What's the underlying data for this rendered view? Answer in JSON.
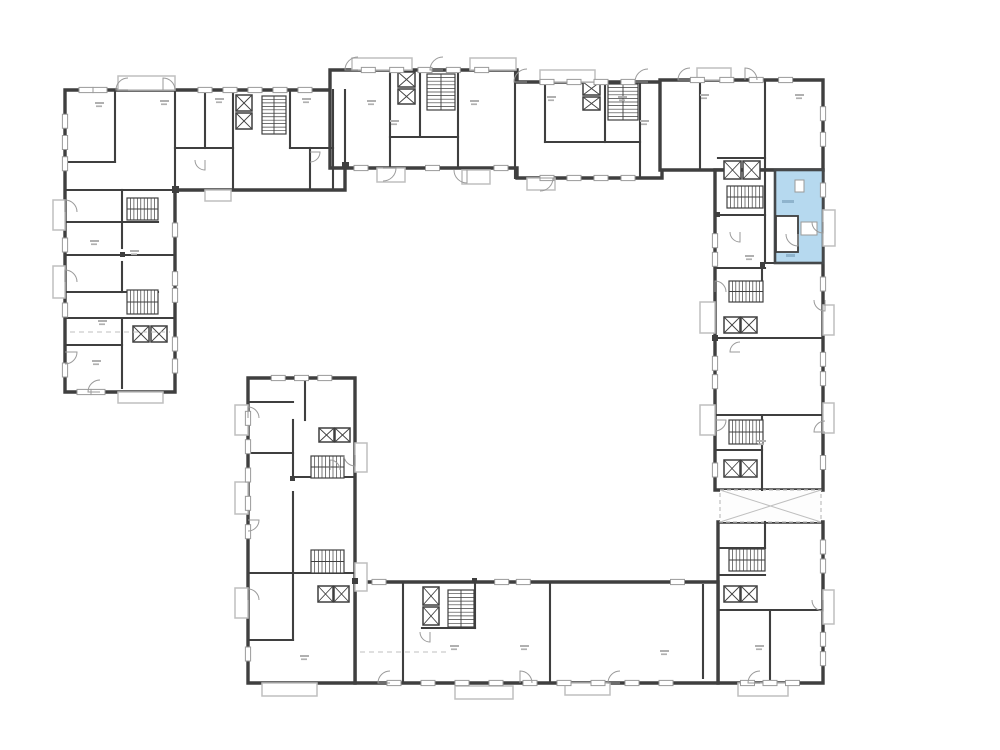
{
  "meta": {
    "title": "building-floor-plan",
    "canvas": {
      "w": 1000,
      "h": 750
    },
    "colors": {
      "background": "#ffffff",
      "wall": "#3f3f3f",
      "wall_medium": "#6a6a6a",
      "thin": "#9a9a9a",
      "lighter": "#bfbfbf",
      "smudge": "#b0b0b0",
      "highlight_fill": "#b6d9ef",
      "highlight_stroke": "#45484a"
    }
  },
  "plan": {
    "wings": [
      {
        "name": "left-l-wing",
        "points": "65,90 345,90 345,190 175,190 175,392 65,392"
      },
      {
        "name": "top-middle-wing",
        "points": "330,70 517,70 517,82 662,82 662,178 517,178 517,168 330,168"
      },
      {
        "name": "top-right-wing",
        "points": "660,80 823,80 823,170 660,170"
      },
      {
        "name": "right-wing",
        "points": "715,170 823,170 823,490 715,490"
      },
      {
        "name": "bottom-right-wing",
        "points": "718,522 823,522 823,683 718,683"
      },
      {
        "name": "bottom-wing",
        "points": "355,582 718,582 718,683 355,683"
      },
      {
        "name": "mid-left-wing",
        "points": "248,378 355,378 355,683 248,683"
      }
    ],
    "connector": {
      "x": 720,
      "y": 490,
      "w": 101,
      "h": 32
    },
    "interior_walls": [
      [
        115,
        90,
        115,
        162
      ],
      [
        175,
        90,
        175,
        190
      ],
      [
        205,
        90,
        205,
        148
      ],
      [
        233,
        90,
        233,
        190
      ],
      [
        290,
        90,
        290,
        148
      ],
      [
        310,
        148,
        310,
        190
      ],
      [
        333,
        90,
        333,
        190
      ],
      [
        175,
        148,
        233,
        148
      ],
      [
        290,
        148,
        333,
        148
      ],
      [
        65,
        162,
        115,
        162
      ],
      [
        65,
        190,
        175,
        190
      ],
      [
        65,
        222,
        158,
        222
      ],
      [
        65,
        255,
        175,
        255
      ],
      [
        65,
        292,
        158,
        292
      ],
      [
        65,
        318,
        175,
        318
      ],
      [
        65,
        345,
        122,
        345
      ],
      [
        122,
        190,
        122,
        248
      ],
      [
        122,
        262,
        122,
        292
      ],
      [
        122,
        318,
        122,
        388
      ],
      [
        345,
        90,
        345,
        168
      ],
      [
        390,
        70,
        390,
        168
      ],
      [
        420,
        70,
        420,
        137
      ],
      [
        458,
        70,
        458,
        168
      ],
      [
        515,
        70,
        515,
        178
      ],
      [
        545,
        82,
        545,
        142
      ],
      [
        605,
        82,
        605,
        142
      ],
      [
        640,
        82,
        640,
        178
      ],
      [
        390,
        137,
        458,
        137
      ],
      [
        545,
        142,
        640,
        142
      ],
      [
        700,
        80,
        700,
        170
      ],
      [
        765,
        80,
        765,
        170
      ],
      [
        718,
        158,
        765,
        158
      ],
      [
        765,
        170,
        765,
        263
      ],
      [
        763,
        263,
        823,
        263
      ],
      [
        715,
        215,
        765,
        215
      ],
      [
        715,
        268,
        765,
        268
      ],
      [
        715,
        338,
        823,
        338
      ],
      [
        715,
        415,
        823,
        415
      ],
      [
        762,
        415,
        762,
        490
      ],
      [
        715,
        450,
        762,
        450
      ],
      [
        762,
        268,
        762,
        300
      ],
      [
        718,
        548,
        765,
        548
      ],
      [
        765,
        522,
        765,
        548
      ],
      [
        718,
        575,
        765,
        575
      ],
      [
        718,
        610,
        823,
        610
      ],
      [
        770,
        610,
        770,
        683
      ],
      [
        403,
        582,
        403,
        683
      ],
      [
        550,
        582,
        550,
        683
      ],
      [
        703,
        585,
        703,
        678
      ],
      [
        422,
        628,
        475,
        628
      ],
      [
        475,
        582,
        475,
        628
      ],
      [
        293,
        420,
        293,
        478
      ],
      [
        293,
        492,
        293,
        640
      ],
      [
        248,
        402,
        293,
        402
      ],
      [
        248,
        453,
        293,
        453
      ],
      [
        293,
        477,
        355,
        477
      ],
      [
        248,
        573,
        355,
        573
      ],
      [
        305,
        378,
        305,
        420
      ],
      [
        248,
        640,
        293,
        640
      ]
    ],
    "stairs": [
      {
        "x": 262,
        "y": 96,
        "w": 24,
        "h": 38,
        "dir": "v"
      },
      {
        "x": 127,
        "y": 198,
        "w": 31,
        "h": 22,
        "dir": "h"
      },
      {
        "x": 127,
        "y": 290,
        "w": 31,
        "h": 24,
        "dir": "h"
      },
      {
        "x": 427,
        "y": 74,
        "w": 28,
        "h": 36,
        "dir": "v"
      },
      {
        "x": 608,
        "y": 84,
        "w": 30,
        "h": 36,
        "dir": "v"
      },
      {
        "x": 727,
        "y": 186,
        "w": 36,
        "h": 22,
        "dir": "h"
      },
      {
        "x": 729,
        "y": 281,
        "w": 34,
        "h": 21,
        "dir": "h"
      },
      {
        "x": 729,
        "y": 420,
        "w": 34,
        "h": 24,
        "dir": "h"
      },
      {
        "x": 729,
        "y": 549,
        "w": 36,
        "h": 22,
        "dir": "h"
      },
      {
        "x": 311,
        "y": 456,
        "w": 33,
        "h": 22,
        "dir": "h"
      },
      {
        "x": 311,
        "y": 550,
        "w": 33,
        "h": 23,
        "dir": "h"
      },
      {
        "x": 448,
        "y": 590,
        "w": 26,
        "h": 37,
        "dir": "v"
      }
    ],
    "elevators": [
      [
        236,
        95,
        16,
        16
      ],
      [
        236,
        113,
        16,
        16
      ],
      [
        133,
        326,
        16,
        16
      ],
      [
        151,
        326,
        16,
        16
      ],
      [
        398,
        72,
        17,
        15
      ],
      [
        398,
        89,
        17,
        15
      ],
      [
        583,
        82,
        17,
        13
      ],
      [
        583,
        97,
        17,
        13
      ],
      [
        724,
        161,
        17,
        18
      ],
      [
        743,
        161,
        17,
        18
      ],
      [
        724,
        317,
        16,
        16
      ],
      [
        741,
        317,
        16,
        16
      ],
      [
        724,
        460,
        16,
        17
      ],
      [
        741,
        460,
        16,
        17
      ],
      [
        724,
        586,
        16,
        16
      ],
      [
        741,
        586,
        16,
        16
      ],
      [
        319,
        428,
        15,
        14
      ],
      [
        335,
        428,
        15,
        14
      ],
      [
        318,
        586,
        15,
        16
      ],
      [
        334,
        586,
        15,
        16
      ],
      [
        423,
        587,
        16,
        18
      ],
      [
        423,
        607,
        16,
        18
      ]
    ],
    "balconies": [
      [
        118,
        76,
        57,
        14
      ],
      [
        53,
        200,
        12,
        30
      ],
      [
        53,
        266,
        12,
        32
      ],
      [
        352,
        58,
        60,
        12
      ],
      [
        470,
        58,
        46,
        12
      ],
      [
        540,
        70,
        55,
        12
      ],
      [
        377,
        168,
        28,
        14
      ],
      [
        462,
        170,
        28,
        14
      ],
      [
        527,
        178,
        28,
        12
      ],
      [
        697,
        68,
        34,
        12
      ],
      [
        823,
        210,
        12,
        36
      ],
      [
        823,
        305,
        11,
        30
      ],
      [
        823,
        403,
        11,
        30
      ],
      [
        700,
        302,
        15,
        31
      ],
      [
        700,
        405,
        15,
        30
      ],
      [
        823,
        590,
        11,
        34
      ],
      [
        738,
        683,
        50,
        13
      ],
      [
        262,
        683,
        55,
        13
      ],
      [
        455,
        686,
        58,
        13
      ],
      [
        565,
        683,
        45,
        12
      ],
      [
        235,
        405,
        13,
        30
      ],
      [
        235,
        482,
        13,
        32
      ],
      [
        235,
        588,
        13,
        30
      ],
      [
        355,
        443,
        12,
        29
      ],
      [
        355,
        563,
        12,
        28
      ],
      [
        205,
        190,
        26,
        11
      ],
      [
        118,
        392,
        45,
        11
      ]
    ],
    "windows": [
      {
        "x1": 72,
        "y1": 90,
        "x2": 114,
        "y2": 90,
        "n": 2
      },
      {
        "x1": 180,
        "y1": 90,
        "x2": 330,
        "y2": 90,
        "n": 5
      },
      {
        "x1": 65,
        "y1": 100,
        "x2": 65,
        "y2": 185,
        "n": 3
      },
      {
        "x1": 65,
        "y1": 228,
        "x2": 65,
        "y2": 262,
        "n": 1
      },
      {
        "x1": 65,
        "y1": 300,
        "x2": 65,
        "y2": 320,
        "n": 1
      },
      {
        "x1": 65,
        "y1": 355,
        "x2": 65,
        "y2": 385,
        "n": 1
      },
      {
        "x1": 70,
        "y1": 392,
        "x2": 112,
        "y2": 392,
        "n": 2
      },
      {
        "x1": 175,
        "y1": 210,
        "x2": 175,
        "y2": 250,
        "n": 1
      },
      {
        "x1": 175,
        "y1": 262,
        "x2": 175,
        "y2": 312,
        "n": 2
      },
      {
        "x1": 175,
        "y1": 322,
        "x2": 175,
        "y2": 388,
        "n": 2
      },
      {
        "x1": 340,
        "y1": 70,
        "x2": 510,
        "y2": 70,
        "n": 5
      },
      {
        "x1": 520,
        "y1": 82,
        "x2": 655,
        "y2": 82,
        "n": 4
      },
      {
        "x1": 350,
        "y1": 168,
        "x2": 372,
        "y2": 168,
        "n": 1
      },
      {
        "x1": 410,
        "y1": 168,
        "x2": 455,
        "y2": 168,
        "n": 1
      },
      {
        "x1": 490,
        "y1": 168,
        "x2": 512,
        "y2": 168,
        "n": 1
      },
      {
        "x1": 520,
        "y1": 178,
        "x2": 655,
        "y2": 178,
        "n": 4
      },
      {
        "x1": 668,
        "y1": 80,
        "x2": 815,
        "y2": 80,
        "n": 4
      },
      {
        "x1": 823,
        "y1": 88,
        "x2": 823,
        "y2": 165,
        "n": 2
      },
      {
        "x1": 823,
        "y1": 175,
        "x2": 823,
        "y2": 205,
        "n": 1
      },
      {
        "x1": 823,
        "y1": 268,
        "x2": 823,
        "y2": 300,
        "n": 1
      },
      {
        "x1": 823,
        "y1": 340,
        "x2": 823,
        "y2": 398,
        "n": 2
      },
      {
        "x1": 823,
        "y1": 440,
        "x2": 823,
        "y2": 485,
        "n": 1
      },
      {
        "x1": 715,
        "y1": 222,
        "x2": 715,
        "y2": 278,
        "n": 2
      },
      {
        "x1": 715,
        "y1": 345,
        "x2": 715,
        "y2": 400,
        "n": 2
      },
      {
        "x1": 715,
        "y1": 455,
        "x2": 715,
        "y2": 485,
        "n": 1
      },
      {
        "x1": 823,
        "y1": 528,
        "x2": 823,
        "y2": 585,
        "n": 2
      },
      {
        "x1": 823,
        "y1": 620,
        "x2": 823,
        "y2": 678,
        "n": 2
      },
      {
        "x1": 725,
        "y1": 683,
        "x2": 815,
        "y2": 683,
        "n": 3
      },
      {
        "x1": 360,
        "y1": 683,
        "x2": 700,
        "y2": 683,
        "n": 9
      },
      {
        "x1": 360,
        "y1": 582,
        "x2": 398,
        "y2": 582,
        "n": 1
      },
      {
        "x1": 480,
        "y1": 582,
        "x2": 545,
        "y2": 582,
        "n": 2
      },
      {
        "x1": 655,
        "y1": 582,
        "x2": 700,
        "y2": 582,
        "n": 1
      },
      {
        "x1": 248,
        "y1": 390,
        "x2": 248,
        "y2": 560,
        "n": 5
      },
      {
        "x1": 248,
        "y1": 630,
        "x2": 248,
        "y2": 678,
        "n": 1
      },
      {
        "x1": 255,
        "y1": 378,
        "x2": 348,
        "y2": 378,
        "n": 3
      }
    ],
    "doors": [
      [
        358,
        70,
        13,
        180,
        270
      ],
      [
        443,
        70,
        13,
        180,
        270
      ],
      [
        527,
        82,
        13,
        180,
        270
      ],
      [
        648,
        82,
        13,
        180,
        270
      ],
      [
        383,
        168,
        13,
        0,
        90
      ],
      [
        467,
        170,
        13,
        90,
        180
      ],
      [
        540,
        178,
        13,
        0,
        90
      ],
      [
        128,
        90,
        12,
        180,
        270
      ],
      [
        163,
        90,
        12,
        270,
        360
      ],
      [
        65,
        212,
        12,
        270,
        360
      ],
      [
        65,
        282,
        12,
        270,
        360
      ],
      [
        65,
        352,
        12,
        0,
        90
      ],
      [
        100,
        392,
        12,
        180,
        270
      ],
      [
        690,
        80,
        12,
        180,
        270
      ],
      [
        745,
        80,
        12,
        270,
        360
      ],
      [
        823,
        222,
        11,
        90,
        180
      ],
      [
        825,
        300,
        11,
        90,
        180
      ],
      [
        825,
        432,
        11,
        180,
        270
      ],
      [
        715,
        292,
        11,
        270,
        360
      ],
      [
        715,
        420,
        11,
        0,
        90
      ],
      [
        823,
        600,
        11,
        90,
        180
      ],
      [
        760,
        683,
        12,
        180,
        270
      ],
      [
        390,
        683,
        12,
        180,
        270
      ],
      [
        520,
        683,
        12,
        270,
        360
      ],
      [
        620,
        683,
        12,
        180,
        270
      ],
      [
        248,
        418,
        11,
        270,
        360
      ],
      [
        248,
        520,
        11,
        0,
        90
      ],
      [
        248,
        600,
        11,
        270,
        360
      ],
      [
        355,
        455,
        11,
        90,
        180
      ],
      [
        205,
        160,
        10,
        90,
        180
      ],
      [
        310,
        152,
        10,
        0,
        90
      ],
      [
        740,
        232,
        10,
        90,
        180
      ],
      [
        740,
        352,
        10,
        180,
        270
      ],
      [
        330,
        470,
        10,
        270,
        360
      ],
      [
        430,
        632,
        10,
        90,
        180
      ]
    ],
    "squares": [
      [
        172,
        186,
        7
      ],
      [
        342,
        162,
        7
      ],
      [
        712,
        335,
        6
      ],
      [
        352,
        578,
        6
      ],
      [
        120,
        252,
        5
      ],
      [
        290,
        476,
        5
      ],
      [
        472,
        578,
        5
      ],
      [
        760,
        262,
        5
      ],
      [
        715,
        212,
        5
      ]
    ],
    "smudges": [
      [
        95,
        102
      ],
      [
        160,
        100
      ],
      [
        215,
        98
      ],
      [
        302,
        98
      ],
      [
        367,
        100
      ],
      [
        470,
        100
      ],
      [
        547,
        96
      ],
      [
        618,
        96
      ],
      [
        700,
        94
      ],
      [
        795,
        94
      ],
      [
        90,
        240
      ],
      [
        92,
        360
      ],
      [
        130,
        250
      ],
      [
        745,
        255
      ],
      [
        757,
        440
      ],
      [
        755,
        645
      ],
      [
        450,
        645
      ],
      [
        300,
        655
      ],
      [
        520,
        645
      ],
      [
        660,
        650
      ],
      [
        390,
        120
      ],
      [
        640,
        120
      ],
      [
        98,
        320
      ]
    ],
    "dashes": [
      [
        70,
        332,
        170,
        332
      ],
      [
        360,
        652,
        450,
        652
      ]
    ],
    "highlight_unit": {
      "rect": [
        775,
        170,
        48,
        93
      ],
      "bath": [
        776,
        216,
        22,
        36
      ],
      "fixtures": [
        [
          795,
          180,
          9,
          12
        ],
        [
          801,
          222,
          16,
          13
        ]
      ],
      "marks": [
        [
          782,
          200,
          12,
          3
        ],
        [
          786,
          254,
          9,
          3
        ]
      ],
      "door": [
        798,
        234,
        12,
        90,
        180
      ]
    }
  }
}
